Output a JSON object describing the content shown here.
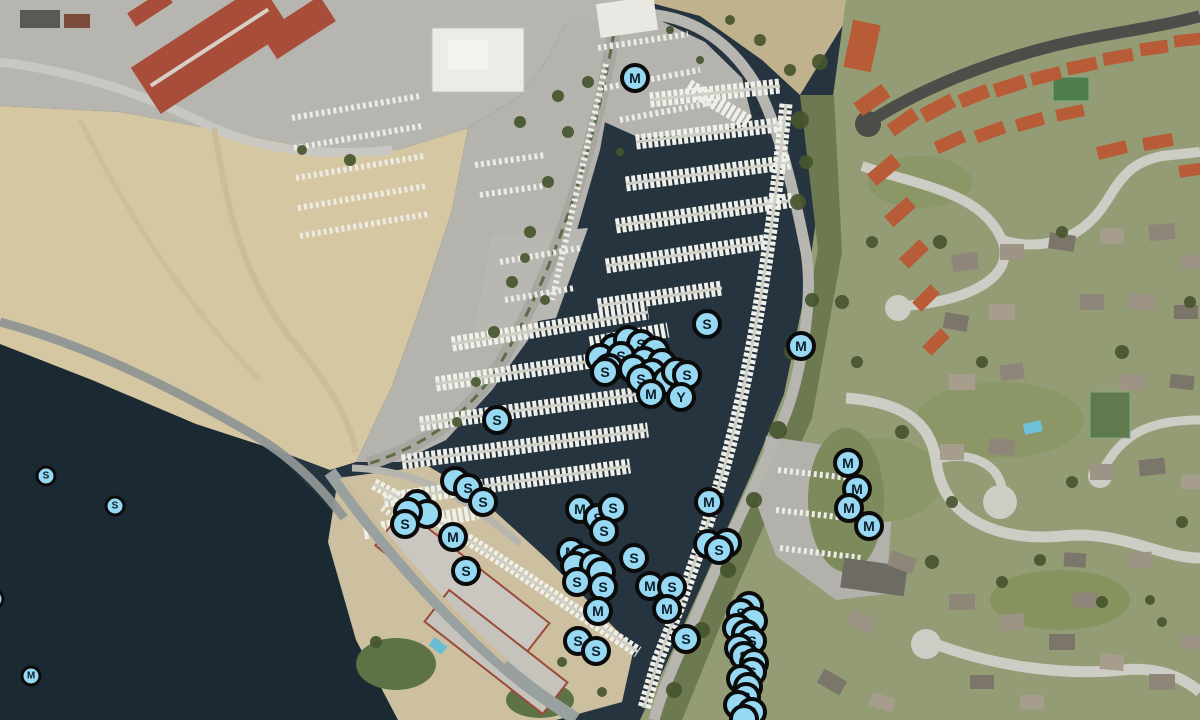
{
  "map": {
    "view_type": "satellite",
    "marker_letters_present": [
      "S",
      "M",
      "Y"
    ],
    "marker_style": {
      "fill": "#97d9f3",
      "border": "#0b0b0b",
      "letter_color": "#0d1e2a"
    },
    "markers": [
      {
        "letter": "M",
        "x": 635,
        "y": 78
      },
      {
        "letter": "S",
        "x": 707,
        "y": 324
      },
      {
        "letter": "M",
        "x": 801,
        "y": 346
      },
      {
        "letter": "S",
        "x": 497,
        "y": 420
      },
      {
        "letter": "",
        "x": 614,
        "y": 348
      },
      {
        "letter": "",
        "x": 628,
        "y": 340
      },
      {
        "letter": "S",
        "x": 641,
        "y": 344
      },
      {
        "letter": "",
        "x": 655,
        "y": 351
      },
      {
        "letter": "",
        "x": 600,
        "y": 358
      },
      {
        "letter": "S",
        "x": 621,
        "y": 356
      },
      {
        "letter": "",
        "x": 644,
        "y": 361
      },
      {
        "letter": "",
        "x": 662,
        "y": 363
      },
      {
        "letter": "",
        "x": 609,
        "y": 368
      },
      {
        "letter": "",
        "x": 633,
        "y": 369
      },
      {
        "letter": "",
        "x": 652,
        "y": 373
      },
      {
        "letter": "S",
        "x": 605,
        "y": 372
      },
      {
        "letter": "",
        "x": 667,
        "y": 381
      },
      {
        "letter": "S",
        "x": 676,
        "y": 372
      },
      {
        "letter": "S",
        "x": 687,
        "y": 375
      },
      {
        "letter": "S",
        "x": 641,
        "y": 379
      },
      {
        "letter": "M",
        "x": 651,
        "y": 394
      },
      {
        "letter": "Y",
        "x": 681,
        "y": 397
      },
      {
        "letter": "",
        "x": 455,
        "y": 481
      },
      {
        "letter": "S",
        "x": 468,
        "y": 488
      },
      {
        "letter": "S",
        "x": 483,
        "y": 502
      },
      {
        "letter": "",
        "x": 417,
        "y": 504
      },
      {
        "letter": "",
        "x": 427,
        "y": 514
      },
      {
        "letter": "",
        "x": 408,
        "y": 512
      },
      {
        "letter": "S",
        "x": 405,
        "y": 524
      },
      {
        "letter": "M",
        "x": 453,
        "y": 537
      },
      {
        "letter": "S",
        "x": 466,
        "y": 571
      },
      {
        "letter": "M",
        "x": 580,
        "y": 509
      },
      {
        "letter": "S",
        "x": 598,
        "y": 518
      },
      {
        "letter": "S",
        "x": 613,
        "y": 508
      },
      {
        "letter": "S",
        "x": 604,
        "y": 531
      },
      {
        "letter": "M",
        "x": 571,
        "y": 552
      },
      {
        "letter": "",
        "x": 583,
        "y": 559
      },
      {
        "letter": "",
        "x": 575,
        "y": 566
      },
      {
        "letter": "",
        "x": 594,
        "y": 565
      },
      {
        "letter": "",
        "x": 601,
        "y": 572
      },
      {
        "letter": "S",
        "x": 577,
        "y": 582
      },
      {
        "letter": "S",
        "x": 603,
        "y": 587
      },
      {
        "letter": "M",
        "x": 598,
        "y": 611
      },
      {
        "letter": "S",
        "x": 634,
        "y": 558
      },
      {
        "letter": "M",
        "x": 650,
        "y": 586
      },
      {
        "letter": "S",
        "x": 672,
        "y": 587
      },
      {
        "letter": "M",
        "x": 667,
        "y": 609
      },
      {
        "letter": "M",
        "x": 709,
        "y": 502
      },
      {
        "letter": "",
        "x": 708,
        "y": 544
      },
      {
        "letter": "",
        "x": 727,
        "y": 543
      },
      {
        "letter": "S",
        "x": 719,
        "y": 550
      },
      {
        "letter": "S",
        "x": 578,
        "y": 641
      },
      {
        "letter": "S",
        "x": 596,
        "y": 651
      },
      {
        "letter": "S",
        "x": 686,
        "y": 639
      },
      {
        "letter": "",
        "x": 749,
        "y": 606
      },
      {
        "letter": "S",
        "x": 741,
        "y": 613
      },
      {
        "letter": "",
        "x": 753,
        "y": 621
      },
      {
        "letter": "",
        "x": 737,
        "y": 628
      },
      {
        "letter": "",
        "x": 746,
        "y": 634
      },
      {
        "letter": "S",
        "x": 752,
        "y": 641
      },
      {
        "letter": "",
        "x": 739,
        "y": 648
      },
      {
        "letter": "S",
        "x": 744,
        "y": 656
      },
      {
        "letter": "",
        "x": 754,
        "y": 663
      },
      {
        "letter": "S",
        "x": 752,
        "y": 672
      },
      {
        "letter": "",
        "x": 741,
        "y": 679
      },
      {
        "letter": "",
        "x": 748,
        "y": 687
      },
      {
        "letter": "S",
        "x": 746,
        "y": 697
      },
      {
        "letter": "",
        "x": 738,
        "y": 705
      },
      {
        "letter": "S",
        "x": 752,
        "y": 712
      },
      {
        "letter": "",
        "x": 744,
        "y": 719
      },
      {
        "letter": "M",
        "x": 848,
        "y": 463
      },
      {
        "letter": "M",
        "x": 857,
        "y": 489
      },
      {
        "letter": "M",
        "x": 849,
        "y": 508
      },
      {
        "letter": "M",
        "x": 869,
        "y": 526
      },
      {
        "letter": "S",
        "x": 46,
        "y": 476,
        "small": true
      },
      {
        "letter": "S",
        "x": 115,
        "y": 506,
        "small": true
      },
      {
        "letter": "M",
        "x": 31,
        "y": 676,
        "small": true
      },
      {
        "letter": "",
        "x": -6,
        "y": 599,
        "small": true
      }
    ]
  }
}
